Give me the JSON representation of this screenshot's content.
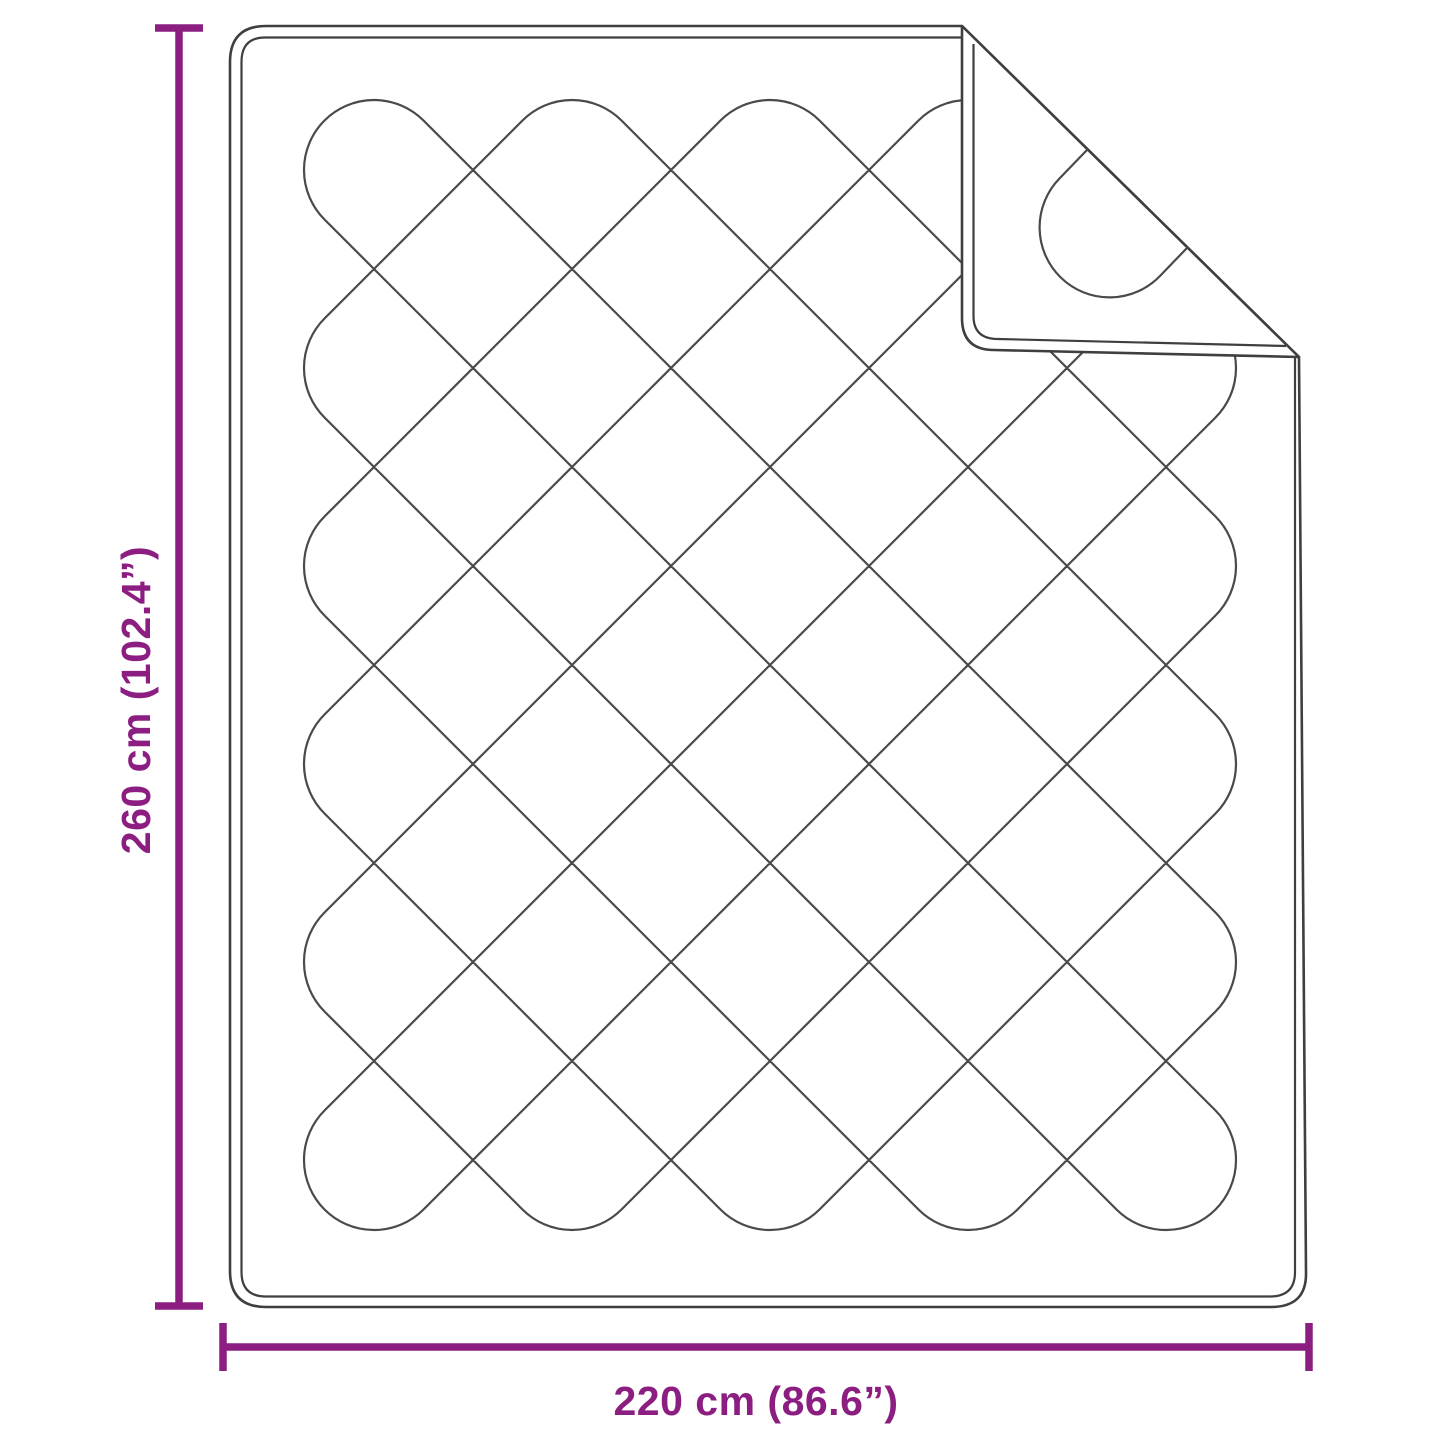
{
  "diagram": {
    "height_label": "260 cm (102.4”)",
    "width_label": "220 cm (86.6”)",
    "colors": {
      "dimension": "#8B1E80",
      "outline": "#3f3f3f",
      "quilting": "#4a4a4a",
      "background": "#ffffff"
    }
  }
}
